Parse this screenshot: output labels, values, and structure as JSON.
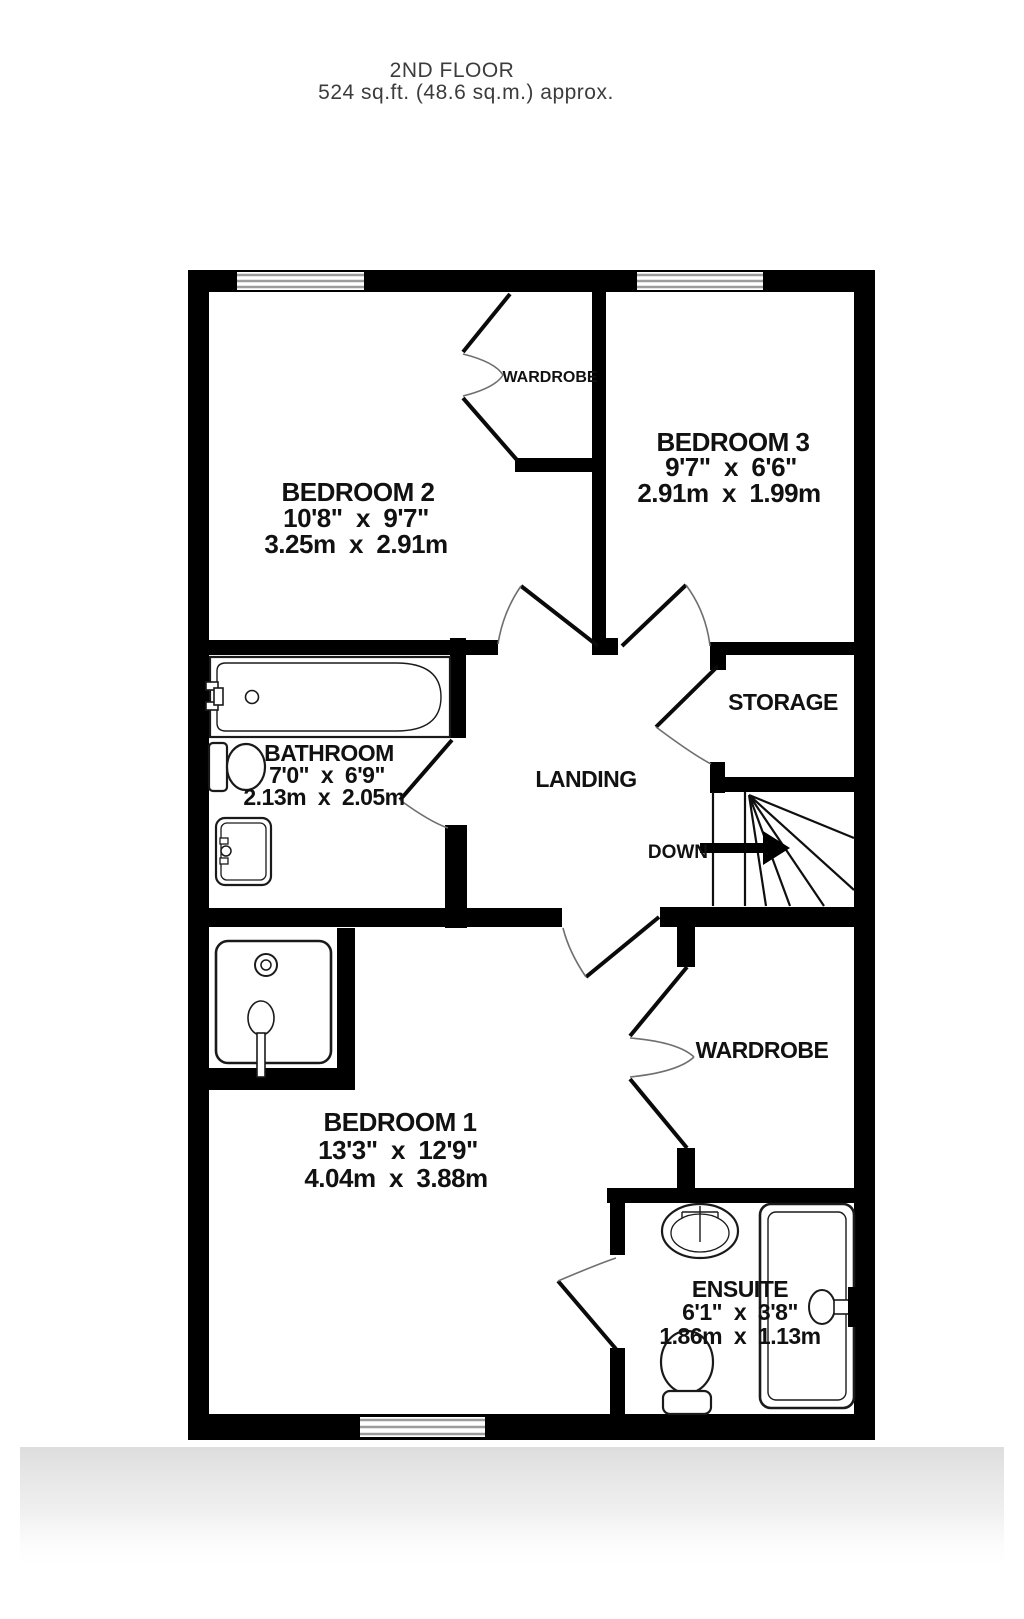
{
  "title": {
    "floor": "2ND FLOOR",
    "area": "524 sq.ft. (48.6 sq.m.) approx."
  },
  "rooms": {
    "bedroom2": {
      "name": "BEDROOM 2",
      "imperial": "10'8\"  x  9'7\"",
      "metric": "3.25m  x  2.91m"
    },
    "bedroom3": {
      "name": "BEDROOM 3",
      "imperial": "9'7\"  x  6'6\"",
      "metric": "2.91m  x  1.99m"
    },
    "bathroom": {
      "name": "BATHROOM",
      "imperial": "7'0\"  x  6'9\"",
      "metric": "2.13m  x  2.05m"
    },
    "bedroom1": {
      "name": "BEDROOM 1",
      "imperial": "13'3\"  x  12'9\"",
      "metric": "4.04m  x  3.88m"
    },
    "ensuite": {
      "name": "ENSUITE",
      "imperial": "6'1\"  x  3'8\"",
      "metric": "1.86m  x  1.13m"
    },
    "landing": {
      "name": "LANDING"
    },
    "storage": {
      "name": "STORAGE"
    }
  },
  "labels": {
    "wardrobe_bedroom2": "WARDROBE",
    "wardrobe_bedroom1": "WARDROBE",
    "stairs_down": "DOWN"
  },
  "colors": {
    "wall": "#000000",
    "fixture_line": "#1a1a1a",
    "window_line": "#9c9c9c",
    "label_text": "#111111",
    "title_text": "#3c3c3c"
  }
}
